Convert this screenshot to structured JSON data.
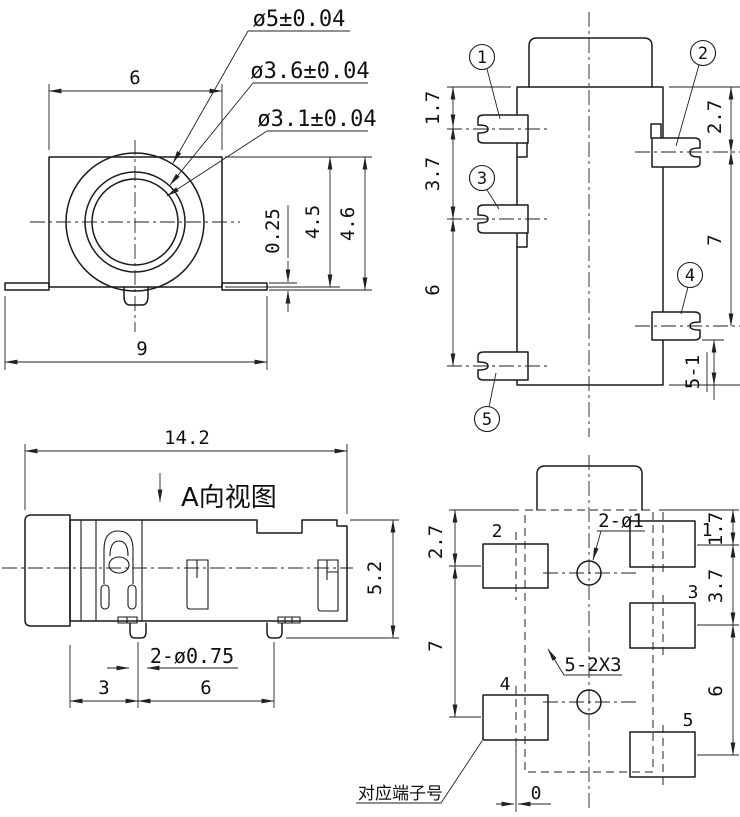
{
  "front_view": {
    "dia_outer": "ø5±0.04",
    "dia_middle": "ø3.6±0.04",
    "dia_inner": "ø3.1±0.04",
    "body_width": "6",
    "tab_thickness": "0.25",
    "body_height": "4.5",
    "total_height": "4.6",
    "total_width": "9"
  },
  "side_view": {
    "terminals": [
      "1",
      "2",
      "3",
      "4",
      "5"
    ],
    "dim_top_to_pin1": "1.7",
    "dim_pin1_to_pin3": "3.7",
    "dim_pin3_to_pin5": "6",
    "dim_top_to_pin2": "2.7",
    "dim_pin2_to_pin4": "7",
    "dim_pin4_to_bottom": "5-1"
  },
  "a_view": {
    "title": "A向视图",
    "total_length": "14.2",
    "body_height": "5.2",
    "peg_dia_note": "2-ø0.75",
    "dim_cap_to_peg": "3",
    "dim_peg_pitch": "6"
  },
  "footprint": {
    "pad_numbers": [
      "1",
      "2",
      "3",
      "4",
      "5"
    ],
    "hole_note": "2-ø1",
    "pad_size_note": "5-2X3",
    "terminal_note": "对应端子号",
    "dim_left_top": "2.7",
    "dim_left_bottom": "7",
    "dim_right_top": "1.7",
    "dim_right_middle": "3.7",
    "dim_right_bottom": "6",
    "dim_zero": "0"
  }
}
